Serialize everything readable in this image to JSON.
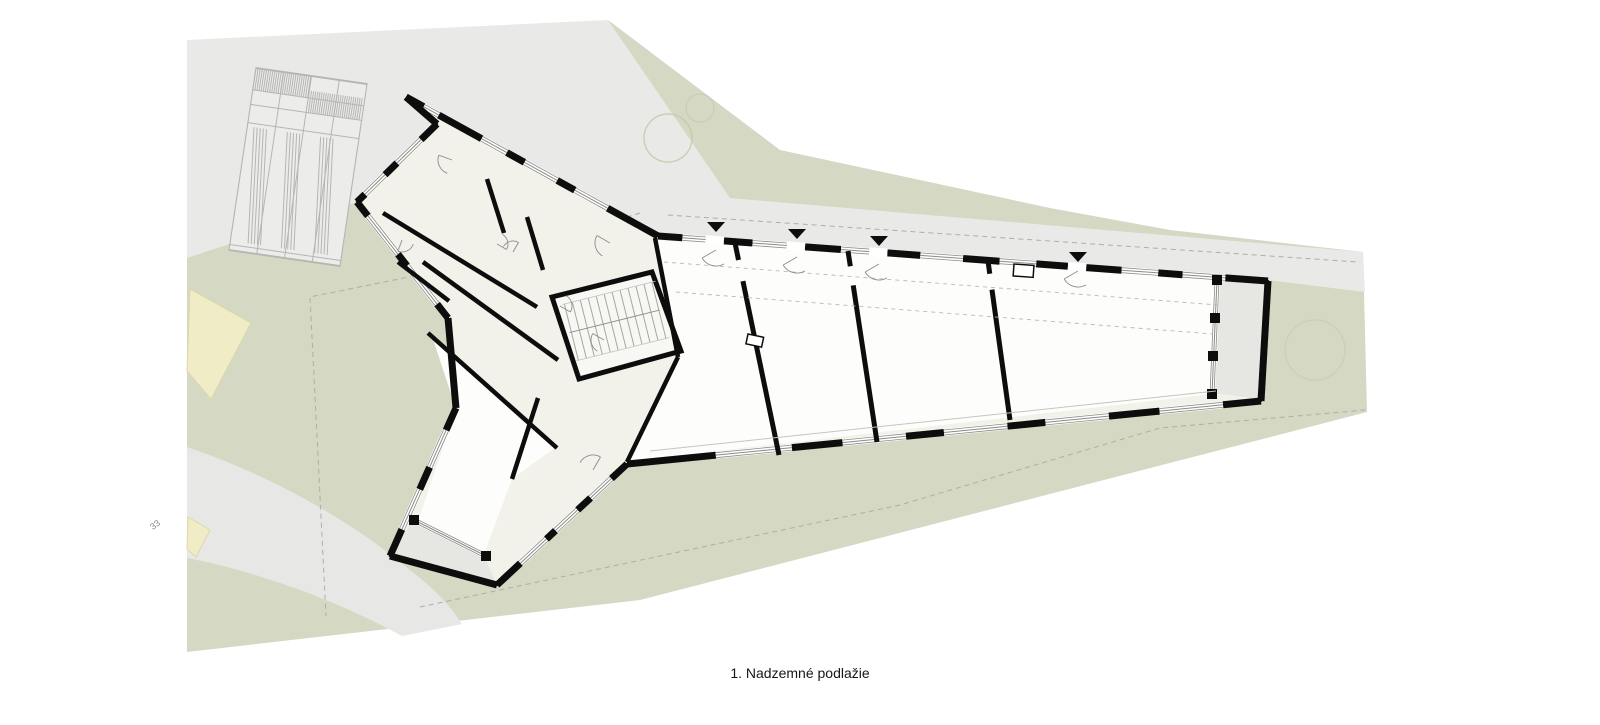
{
  "caption": {
    "text": "1. Nadzemné podlažie"
  },
  "labels": {
    "parcel_number": "33"
  },
  "markers": {
    "entrance_symbol": "filled-triangle-down",
    "entrance_count": 4
  },
  "palette": {
    "page_white": "#ffffff",
    "site_green": "#d5d8c3",
    "road_gray": "#e9e9e7",
    "path_gray": "#e7e7e5",
    "terrace_gray": "#e6e6e2",
    "building_cream": "#f3f2ea",
    "room_white": "#fdfdfc",
    "wall_black": "#0d0d0d",
    "window_line": "#8a8a86",
    "neighbor_fill": "#ececea",
    "neighbor_line": "#b5b5b2",
    "cream_building": "#efecc6",
    "dash_line": "#aeaea8",
    "tree_line": "#c2c7ab",
    "text_color": "#161616"
  }
}
